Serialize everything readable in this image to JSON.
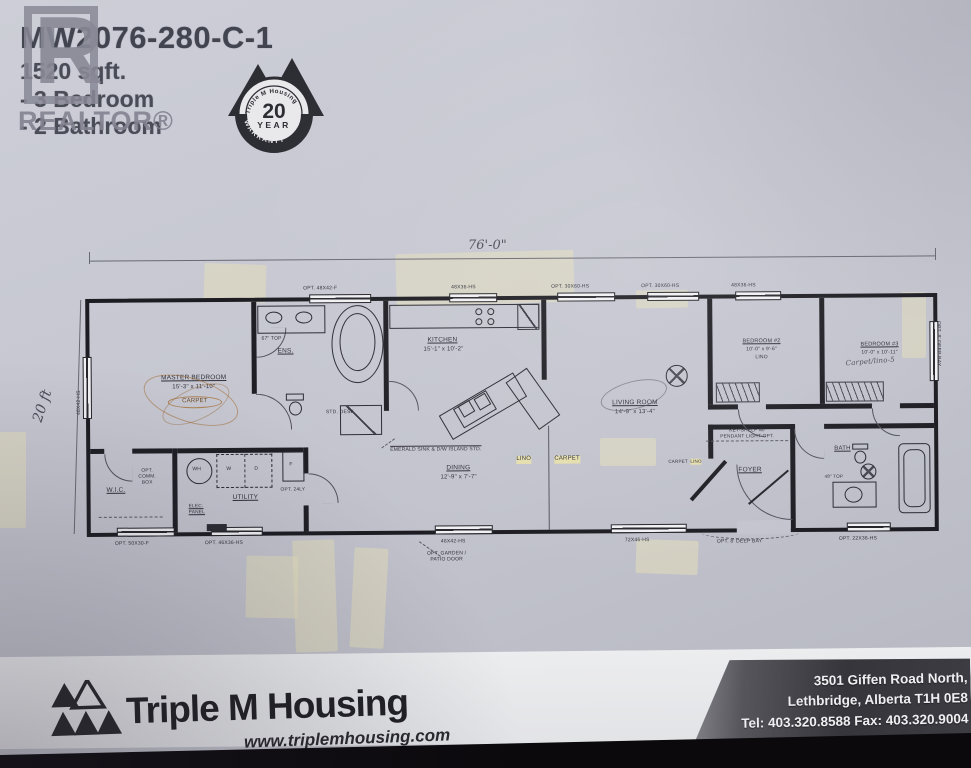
{
  "photo_colors": {
    "paper": "#c7c8d2",
    "plan_ink": "#26262c",
    "tape": "#e2dcba",
    "footer_band": "#3a3a40",
    "footer_black": "#0b090c"
  },
  "header": {
    "model": "MW2076-280-C-1",
    "spec_area": "1520 sqft.",
    "spec_bedrooms": "- 3 Bedroom",
    "spec_bathrooms": "- 2 Bathroom",
    "watermark_letter": "R",
    "watermark_text": "REALTOR®"
  },
  "warranty_badge": {
    "brand": "Triple M Housing",
    "number": "20",
    "year_word": "YEAR",
    "warranty_word": "WARRANTY"
  },
  "floor_plan": {
    "overall_width": "76'-0\"",
    "depth_note": "20 ft",
    "rooms": {
      "master": {
        "name": "MASTER BEDROOM",
        "dims": "15'-3\" x 11'-10\"",
        "floor": "CARPET"
      },
      "wic": {
        "name": "W.I.C."
      },
      "ens": {
        "name": "ENS.",
        "counter": "67\" TOP"
      },
      "utility": {
        "name": "UTILITY"
      },
      "kitchen": {
        "name": "KITCHEN",
        "dims": "15'-1\" x 10'-2\""
      },
      "dining": {
        "name": "DINING",
        "dims": "12'-9\" x 7'-7\""
      },
      "living": {
        "name": "LIVING ROOM",
        "dims": "14'-9\" x 13'-4\""
      },
      "bed2": {
        "name": "BEDROOM #2",
        "dims": "10'-0\" x 9'-6\"",
        "floor": "LINO"
      },
      "bed3": {
        "name": "BEDROOM #3",
        "dims": "10'-0\" x 10'-11\"",
        "note": "Carpet/lino-5"
      },
      "foyer": {
        "name": "FOYER"
      },
      "bath": {
        "name": "BATH",
        "counter": "48\" TOP"
      }
    },
    "labels": {
      "island_note": "EMERALD SINK & D/W ISLAND STD.",
      "std_desk": "STD. DESK",
      "key_shelf_1": "KEY-SHELF W/",
      "key_shelf_2": "PENDANT LIGHT-OPT.",
      "lino": "LINO",
      "carpet": "CARPET",
      "foyer_carpet": "CARPET",
      "foyer_lino": "LINO",
      "comm_box_1": "OPT.",
      "comm_box_2": "COMM.",
      "comm_box_3": "BOX",
      "elec_1": "ELEC.",
      "elec_2": "PANEL",
      "opt_laundry": "OPT. 24LY",
      "wh": "WH",
      "washer": "W",
      "dryer": "D",
      "furnace": "F"
    },
    "windows": {
      "top_1": "OPT. 48X42-F",
      "top_2": "48X36-HS",
      "top_3": "OPT. 30X60-HS",
      "top_4": "OPT. 30X60-HS",
      "top_5": "48X36-HS",
      "right_bay": "OPT. 8' DEEP BAY",
      "left_1": "48X42-HS",
      "bottom_1": "OPT. 50X30-F",
      "bottom_2": "OPT. 46X36-HS",
      "bottom_3": "46X42-HS",
      "patio_1": "OPT. GARDEN /",
      "patio_2": "PATIO DOOR",
      "bottom_4": "72X46-HS",
      "bottom_bay": "OPT. 8' DEEP BAY",
      "bottom_5": "OPT. 22X36-HS"
    }
  },
  "footer": {
    "brand": "Triple M Housing",
    "website": "www.triplemhousing.com",
    "address_1": "3501 Giffen Road North,",
    "address_2": "Lethbridge, Alberta T1H 0E8",
    "address_3": "Tel: 403.320.8588 Fax: 403.320.9004"
  }
}
